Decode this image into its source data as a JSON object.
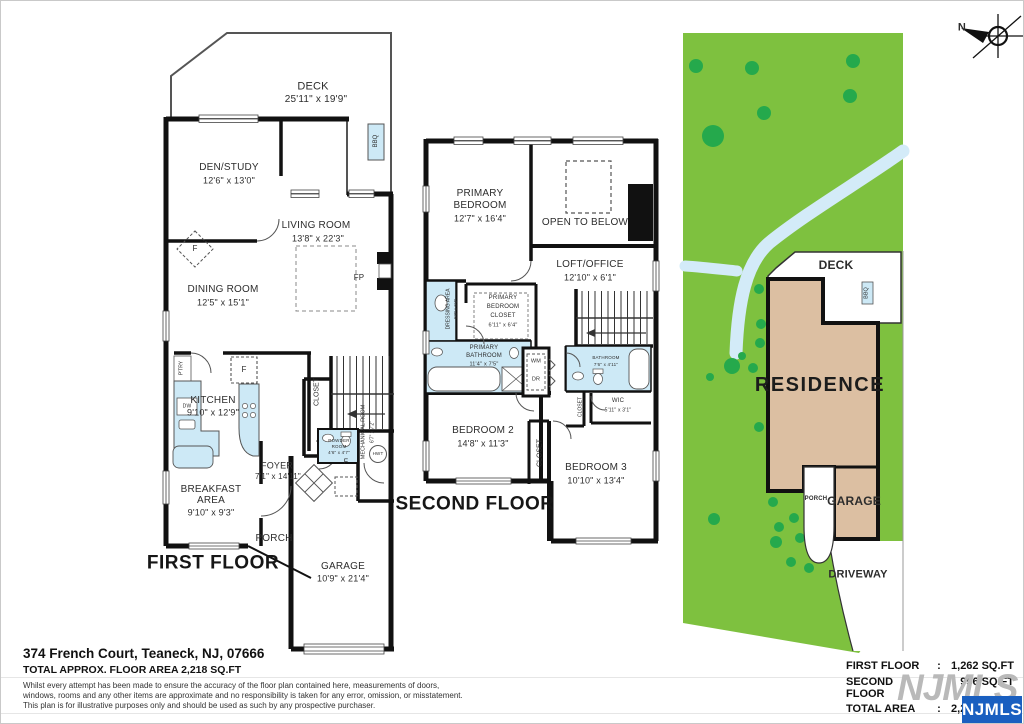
{
  "compass": {
    "north_label": "N"
  },
  "first_floor": {
    "title": "FIRST FLOOR",
    "deck": {
      "name": "DECK",
      "dims": "25'11\" x 19'9\""
    },
    "den_study": {
      "name": "DEN/STUDY",
      "dims": "12'6\" x 13'0\""
    },
    "living_room": {
      "name": "LIVING ROOM",
      "dims": "13'8\" x 22'3\""
    },
    "dining_room": {
      "name": "DINING ROOM",
      "dims": "12'5\" x 15'1\""
    },
    "kitchen": {
      "name": "KITCHEN",
      "dims": "9'10\" x 12'9\""
    },
    "foyer": {
      "name": "FOYER",
      "dims": "7'1\" x 14'11\""
    },
    "breakfast_area": {
      "line1": "BREAKFAST",
      "line2": "AREA",
      "dims": "9'10\" x 9'3\""
    },
    "porch": {
      "name": "PORCH"
    },
    "garage": {
      "name": "GARAGE",
      "dims": "10'9\" x 21'4\""
    },
    "mechanical_room": {
      "name": "MECHANICAL ROOM",
      "dims": "6'7\" x 7'2\""
    },
    "powder_room": {
      "line1": "POWDER",
      "line2": "ROOM",
      "dims": "4'6\" x 4'7\""
    },
    "closet": "CLOSET",
    "pantry": "P'TRY",
    "dishwasher": "DW",
    "fridge": "F",
    "ceiling_fan": "F",
    "foyer_closet": "F",
    "fireplace": "FP",
    "bbq": "BBQ",
    "water_heater": "HWT"
  },
  "second_floor": {
    "title": "SECOND FLOOR",
    "primary_bedroom": {
      "line1": "PRIMARY",
      "line2": "BEDROOM",
      "dims": "12'7\" x 16'4\""
    },
    "open_to_below": "OPEN TO BELOW",
    "loft_office": {
      "name": "LOFT/OFFICE",
      "dims": "12'10\" x 6'1\""
    },
    "dressing_area": {
      "name": "DRESSING AREA",
      "dims": "5'3\" x 6'4\""
    },
    "primary_bedroom_closet": {
      "line1": "PRIMARY",
      "line2": "BEDROOM",
      "line3": "CLOSET",
      "dims": "6'11\" x 6'4\""
    },
    "primary_bathroom": {
      "line1": "PRIMARY",
      "line2": "BATHROOM",
      "dims": "11'4\" x 7'5\""
    },
    "bathroom": {
      "name": "BATHROOM",
      "dims": "7'6\" x 4'11\""
    },
    "wic": {
      "name": "WIC",
      "dims": "5'11\" x 3'1\""
    },
    "bedroom2": {
      "name": "BEDROOM 2",
      "dims": "14'8\" x 11'3\""
    },
    "bedroom3": {
      "name": "BEDROOM 3",
      "dims": "10'10\" x 13'4\""
    },
    "closet_hall": "CLOSET",
    "closet_bedroom3": "CLOSET",
    "washer": "WM",
    "dryer": "DR"
  },
  "site_plan": {
    "deck": "DECK",
    "bbq": "BBQ",
    "residence": "RESIDENCE",
    "porch": "PORCH",
    "garage": "GARAGE",
    "driveway": "DRIVEWAY"
  },
  "footer": {
    "address": "374 French Court, Teaneck, NJ, 07666",
    "total_line": "TOTAL APPROX. FLOOR AREA 2,218 SQ.FT",
    "disclaimer_line1": "Whilst every attempt has been made to ensure the accuracy of the floor plan contained here, measurements of doors,",
    "disclaimer_line2": "windows, rooms and any other items are approximate and no responsibility is taken for any error, omission, or misstatement.",
    "disclaimer_line3": "This plan is for illustrative purposes only and should be used as such by any prospective purchaser.",
    "colon": ":",
    "areas": [
      {
        "label": "FIRST FLOOR",
        "value": "1,262 SQ.FT"
      },
      {
        "label": "SECOND FLOOR",
        "value": "956 SQ.FT"
      },
      {
        "label": "TOTAL AREA",
        "value": "2,218 SQ.FT"
      }
    ],
    "watermark": "NJMLS",
    "logo": "NJMLS"
  },
  "colors": {
    "lawn": "#7ec13f",
    "tree": "#25a94c",
    "water": "#d3ebf8",
    "residence": "#dcbfa2",
    "fixture": "#cde9f6",
    "logo_blue": "#1a5fc0"
  }
}
